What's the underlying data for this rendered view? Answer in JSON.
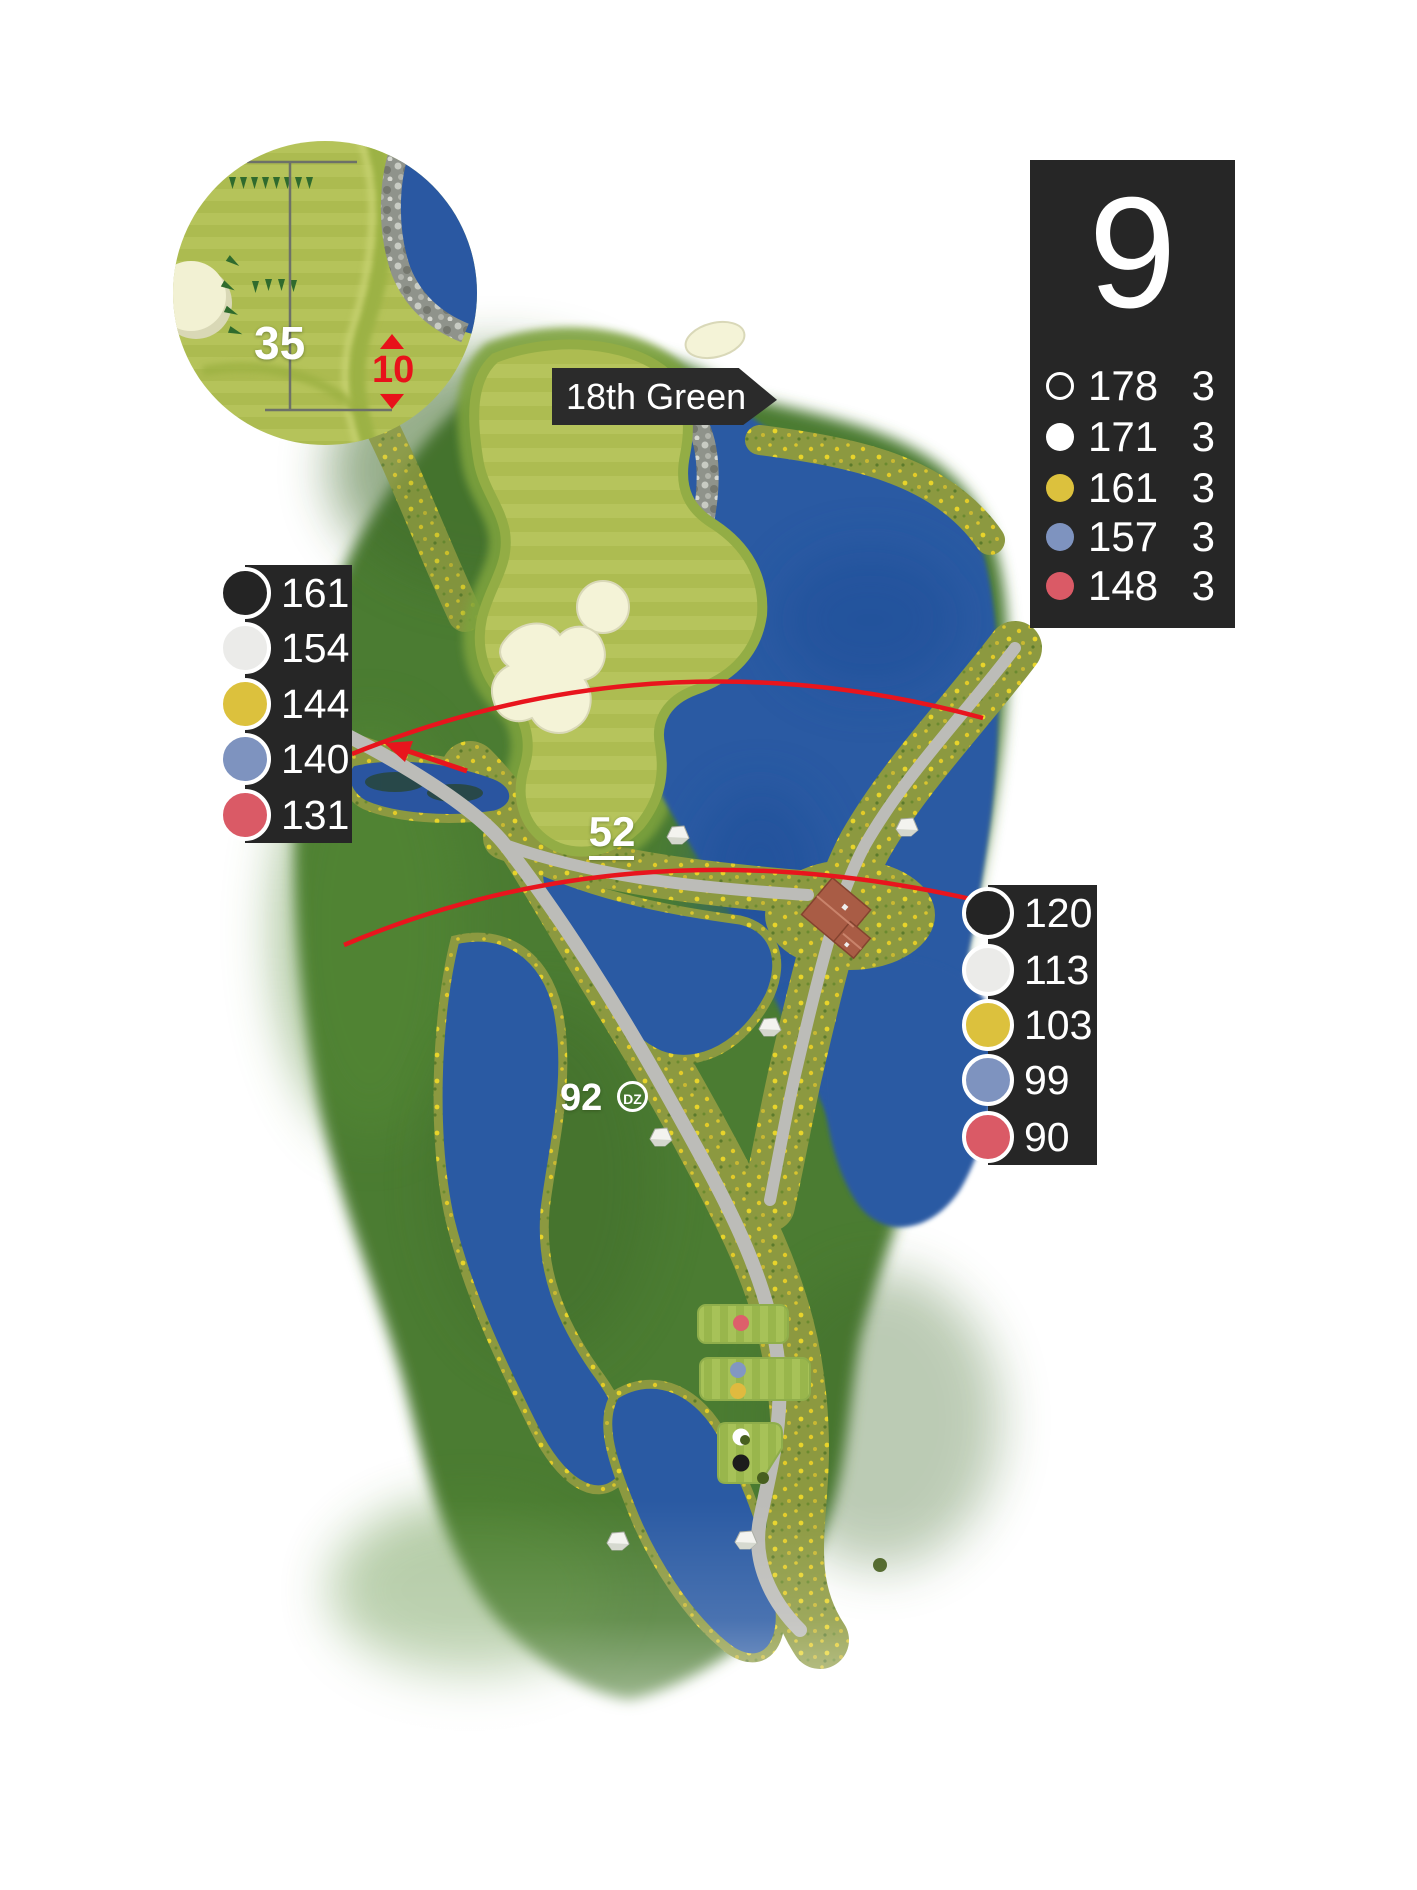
{
  "hole": {
    "number": "9",
    "tees": [
      {
        "marker": "open-circle",
        "yards": "178",
        "par": "3"
      },
      {
        "marker": "white",
        "yards": "171",
        "par": "3"
      },
      {
        "marker": "yellow",
        "yards": "161",
        "par": "3"
      },
      {
        "marker": "blue",
        "yards": "157",
        "par": "3"
      },
      {
        "marker": "red",
        "yards": "148",
        "par": "3"
      }
    ]
  },
  "inset": {
    "green_depth": "35",
    "carry_over_hazard": "10"
  },
  "banner": {
    "label": "18th Green"
  },
  "map_markers": {
    "mid_fairway_distance": "52",
    "dropzone_distance": "92",
    "dropzone_badge": "DZ"
  },
  "left_panel": {
    "rows": [
      {
        "marker": "black",
        "yards": "161"
      },
      {
        "marker": "white",
        "yards": "154"
      },
      {
        "marker": "yellow",
        "yards": "144"
      },
      {
        "marker": "blue",
        "yards": "140"
      },
      {
        "marker": "red",
        "yards": "131"
      }
    ]
  },
  "right_panel": {
    "rows": [
      {
        "marker": "black",
        "yards": "120"
      },
      {
        "marker": "white",
        "yards": "113"
      },
      {
        "marker": "yellow",
        "yards": "103"
      },
      {
        "marker": "blue",
        "yards": "99"
      },
      {
        "marker": "red",
        "yards": "90"
      }
    ]
  },
  "colors": {
    "panel_bg": "#262626",
    "marker_yellow": "#dcc13d",
    "marker_blue": "#7e93bf",
    "marker_red": "#da5a66",
    "marker_black": "#242424",
    "marker_white": "#ffffff",
    "water": "#2a5aa3",
    "rough_green": "#4b7b31",
    "green_light": "#b6c45c",
    "path_gray": "#bcbcb8",
    "accent_red": "#e8151d"
  }
}
